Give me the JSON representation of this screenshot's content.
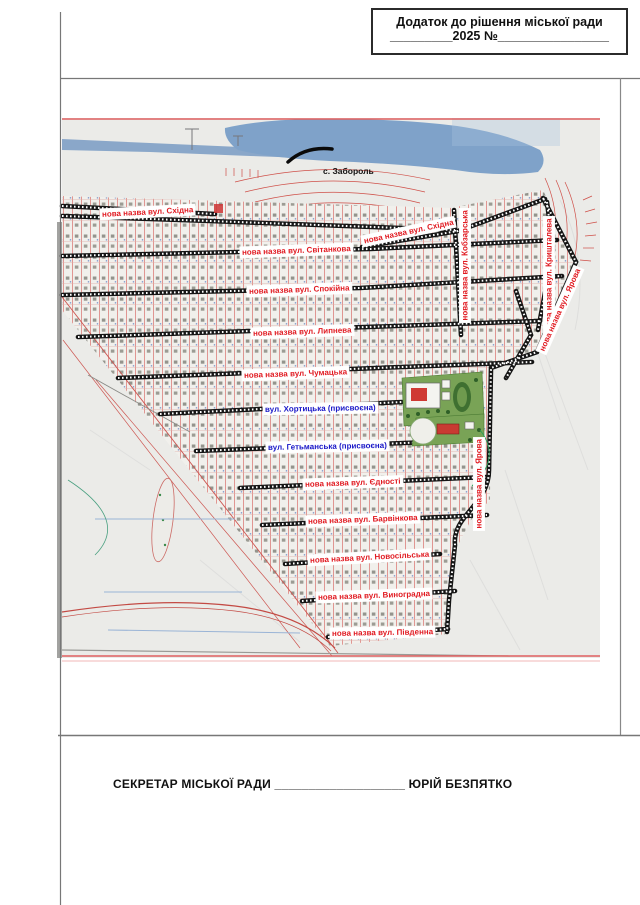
{
  "header": {
    "line1": "Додаток  до рішення міської ради",
    "line2": "_________2025 №________________"
  },
  "footer": {
    "label": "СЕКРЕТАР МІСЬКОЇ РАДИ",
    "blank": " ___________________ ",
    "name": "ЮРІЙ БЕЗПЯТКО"
  },
  "map": {
    "village_label": "с. Забороль",
    "colors": {
      "new_name_text": "#e11b22",
      "assigned_text": "#1a18c8",
      "water": "#85a5ca",
      "scan_paper": "#ebebe8",
      "road": "#151515",
      "contour": "#cf4f48",
      "park": "#79a356"
    },
    "streets": [
      {
        "text": "нова назва вул. Східна",
        "x": 100,
        "y": 214,
        "rot": -3,
        "kind": "new"
      },
      {
        "text": "нова назва вул. Східна",
        "x": 362,
        "y": 241,
        "rot": -12,
        "kind": "new"
      },
      {
        "text": "нова назва вул. Світанкова",
        "x": 240,
        "y": 252,
        "rot": -2,
        "kind": "new"
      },
      {
        "text": "нова назва вул. Спокійна",
        "x": 247,
        "y": 291,
        "rot": -2,
        "kind": "new"
      },
      {
        "text": "нова назва вул. Липнева",
        "x": 251,
        "y": 333,
        "rot": -2,
        "kind": "new"
      },
      {
        "text": "нова назва вул. Чумацька",
        "x": 242,
        "y": 375,
        "rot": -2,
        "kind": "new"
      },
      {
        "text": "вул. Хортицька (присвоєна)",
        "x": 263,
        "y": 409,
        "rot": -1,
        "kind": "assigned"
      },
      {
        "text": "вул. Гетьманська (присвоєна)",
        "x": 266,
        "y": 447,
        "rot": -1,
        "kind": "assigned"
      },
      {
        "text": "нова назва вул. Єдності",
        "x": 303,
        "y": 484,
        "rot": -2,
        "kind": "new"
      },
      {
        "text": "нова назва вул. Барвінкова",
        "x": 306,
        "y": 521,
        "rot": -2,
        "kind": "new"
      },
      {
        "text": "нова назва вул. Новосільська",
        "x": 308,
        "y": 560,
        "rot": -3,
        "kind": "new"
      },
      {
        "text": "нова назва вул. Виноградна",
        "x": 316,
        "y": 597,
        "rot": -2,
        "kind": "new"
      },
      {
        "text": "нова назва вул. Південна",
        "x": 330,
        "y": 633,
        "rot": -1,
        "kind": "new"
      },
      {
        "text": "нова назва вул. Кобзарська",
        "x": 465,
        "y": 322,
        "rot": -90,
        "kind": "new"
      },
      {
        "text": "нова назва вул. Кришталева",
        "x": 549,
        "y": 333,
        "rot": -90,
        "kind": "new"
      },
      {
        "text": "нова назва вул. Ярова",
        "x": 541,
        "y": 352,
        "rot": -66,
        "kind": "new"
      },
      {
        "text": "нова назва вул. Ярова",
        "x": 479,
        "y": 530,
        "rot": -90,
        "kind": "new"
      }
    ]
  }
}
